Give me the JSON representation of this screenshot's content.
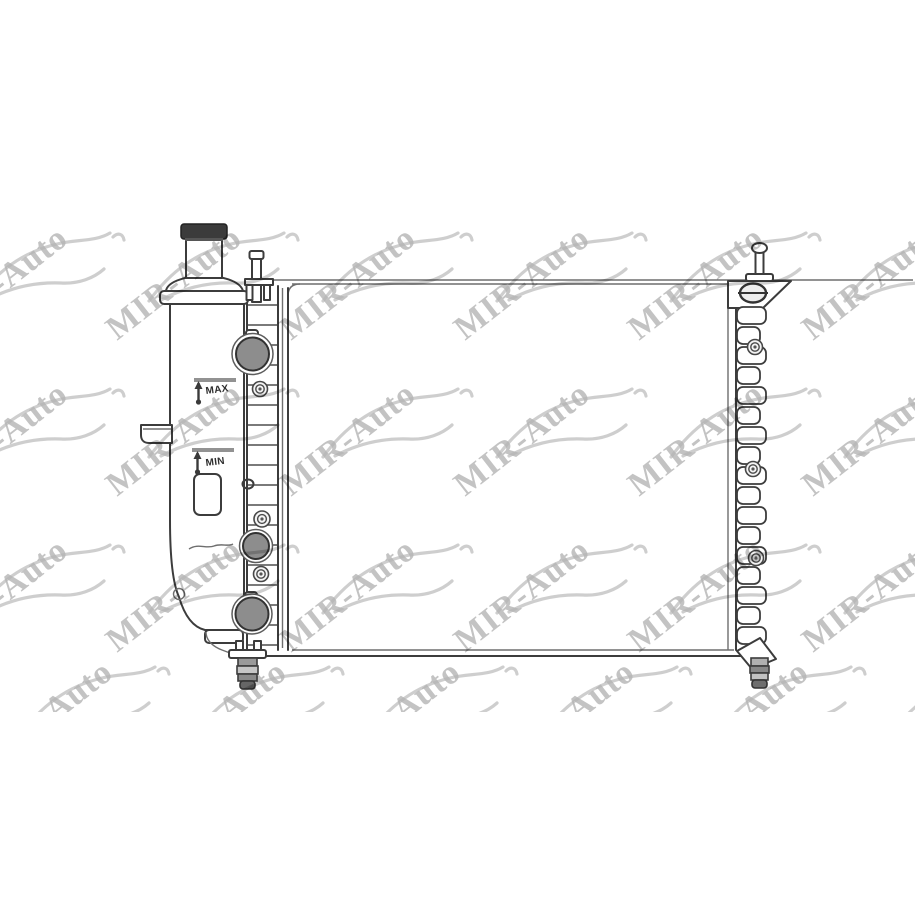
{
  "image": {
    "width": 915,
    "height": 915,
    "background": "#ffffff"
  },
  "labels": {
    "max": "MAX",
    "min": "MIN"
  },
  "colors": {
    "line": "#3c3c3c",
    "line_light": "#6e6e6e",
    "port_fill": "#8d8d8d",
    "cap_fill": "#3b3b3b",
    "watermark_text": "#b4b4b4",
    "watermark_car": "#c9c9c9"
  },
  "watermark": {
    "text": "MIR-Auto",
    "angle_deg": -38,
    "band": {
      "top": 222,
      "bottom": 712
    },
    "tiles": [
      {
        "x": -57,
        "y": 341
      },
      {
        "x": 117,
        "y": 341
      },
      {
        "x": 291,
        "y": 341
      },
      {
        "x": 465,
        "y": 341
      },
      {
        "x": 639,
        "y": 341
      },
      {
        "x": 813,
        "y": 341
      },
      {
        "x": -57,
        "y": 497
      },
      {
        "x": 117,
        "y": 497
      },
      {
        "x": 291,
        "y": 497
      },
      {
        "x": 465,
        "y": 497
      },
      {
        "x": 639,
        "y": 497
      },
      {
        "x": 813,
        "y": 497
      },
      {
        "x": -57,
        "y": 653
      },
      {
        "x": 117,
        "y": 653
      },
      {
        "x": 291,
        "y": 653
      },
      {
        "x": 465,
        "y": 653
      },
      {
        "x": 639,
        "y": 653
      },
      {
        "x": 813,
        "y": 653
      },
      {
        "x": -12,
        "y": 775
      },
      {
        "x": 162,
        "y": 775
      },
      {
        "x": 336,
        "y": 775
      },
      {
        "x": 510,
        "y": 775
      },
      {
        "x": 684,
        "y": 775
      },
      {
        "x": 858,
        "y": 775
      }
    ]
  }
}
